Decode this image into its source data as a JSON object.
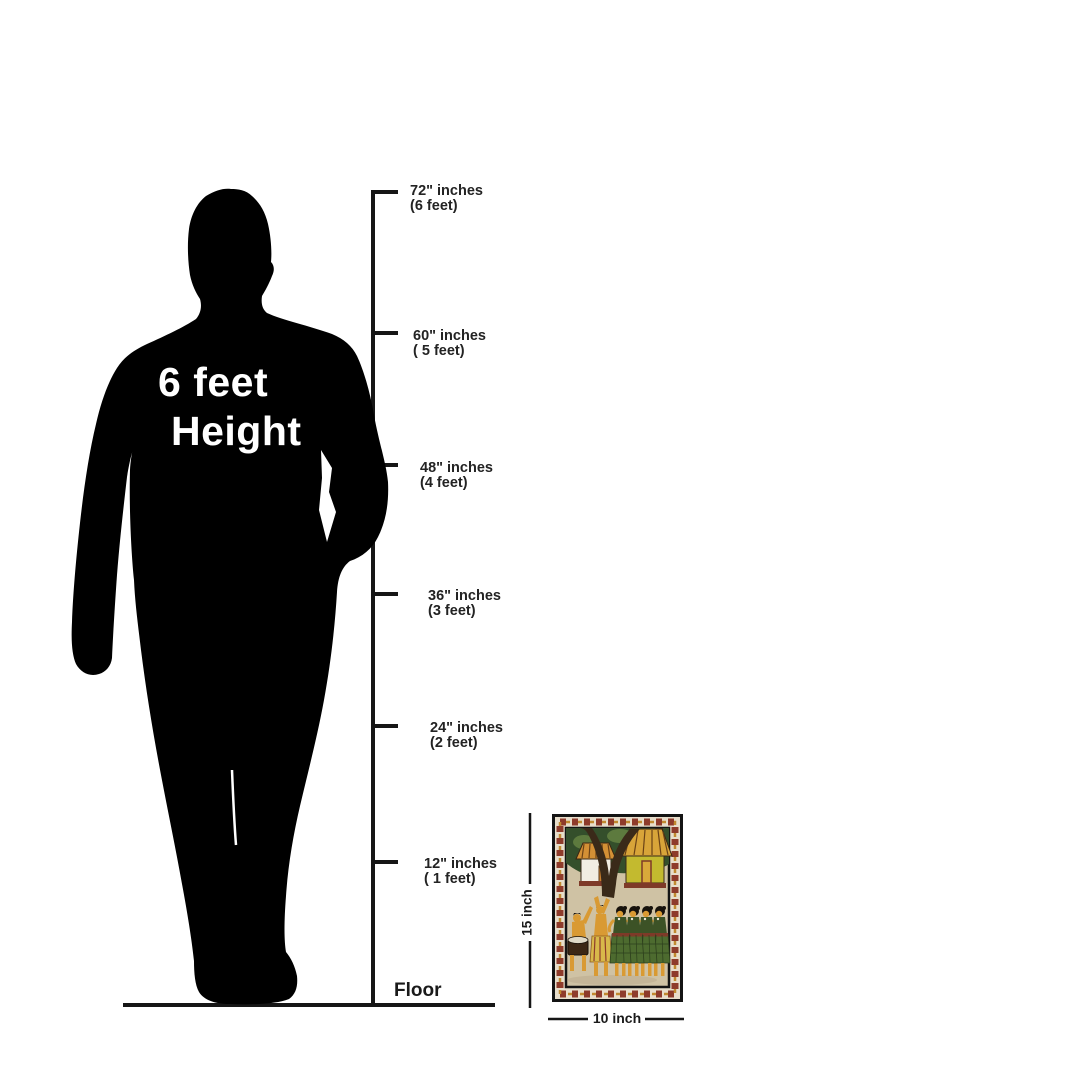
{
  "title": {
    "line1": "6 feet",
    "line2": "Height"
  },
  "ruler": {
    "marks": [
      {
        "inches": "72\" inches",
        "feet": "(6 feet)"
      },
      {
        "inches": "60\" inches",
        "feet": "( 5 feet)"
      },
      {
        "inches": "48\" inches",
        "feet": "(4 feet)"
      },
      {
        "inches": "36\" inches",
        "feet": "(3 feet)"
      },
      {
        "inches": "24\" inches",
        "feet": "(2 feet)"
      },
      {
        "inches": "12\" inches",
        "feet": "( 1 feet)"
      }
    ],
    "floor_label": "Floor"
  },
  "artwork": {
    "height_label": "15 inch",
    "width_label": "10 inch"
  },
  "colors": {
    "ink": "#161616",
    "silhouette": "#000000",
    "title_text": "#ffffff",
    "painting_border_bg": "#e8decb",
    "painting_motif_red": "#8e3b2b",
    "painting_motif_ochre": "#c1892f",
    "painting_scene_bg": "#cfc2a4",
    "painting_foliage": "#344f2b",
    "painting_trunk": "#3a2a19",
    "painting_figure": "#d99a33",
    "painting_skirt_green": "#4d6b2f"
  }
}
